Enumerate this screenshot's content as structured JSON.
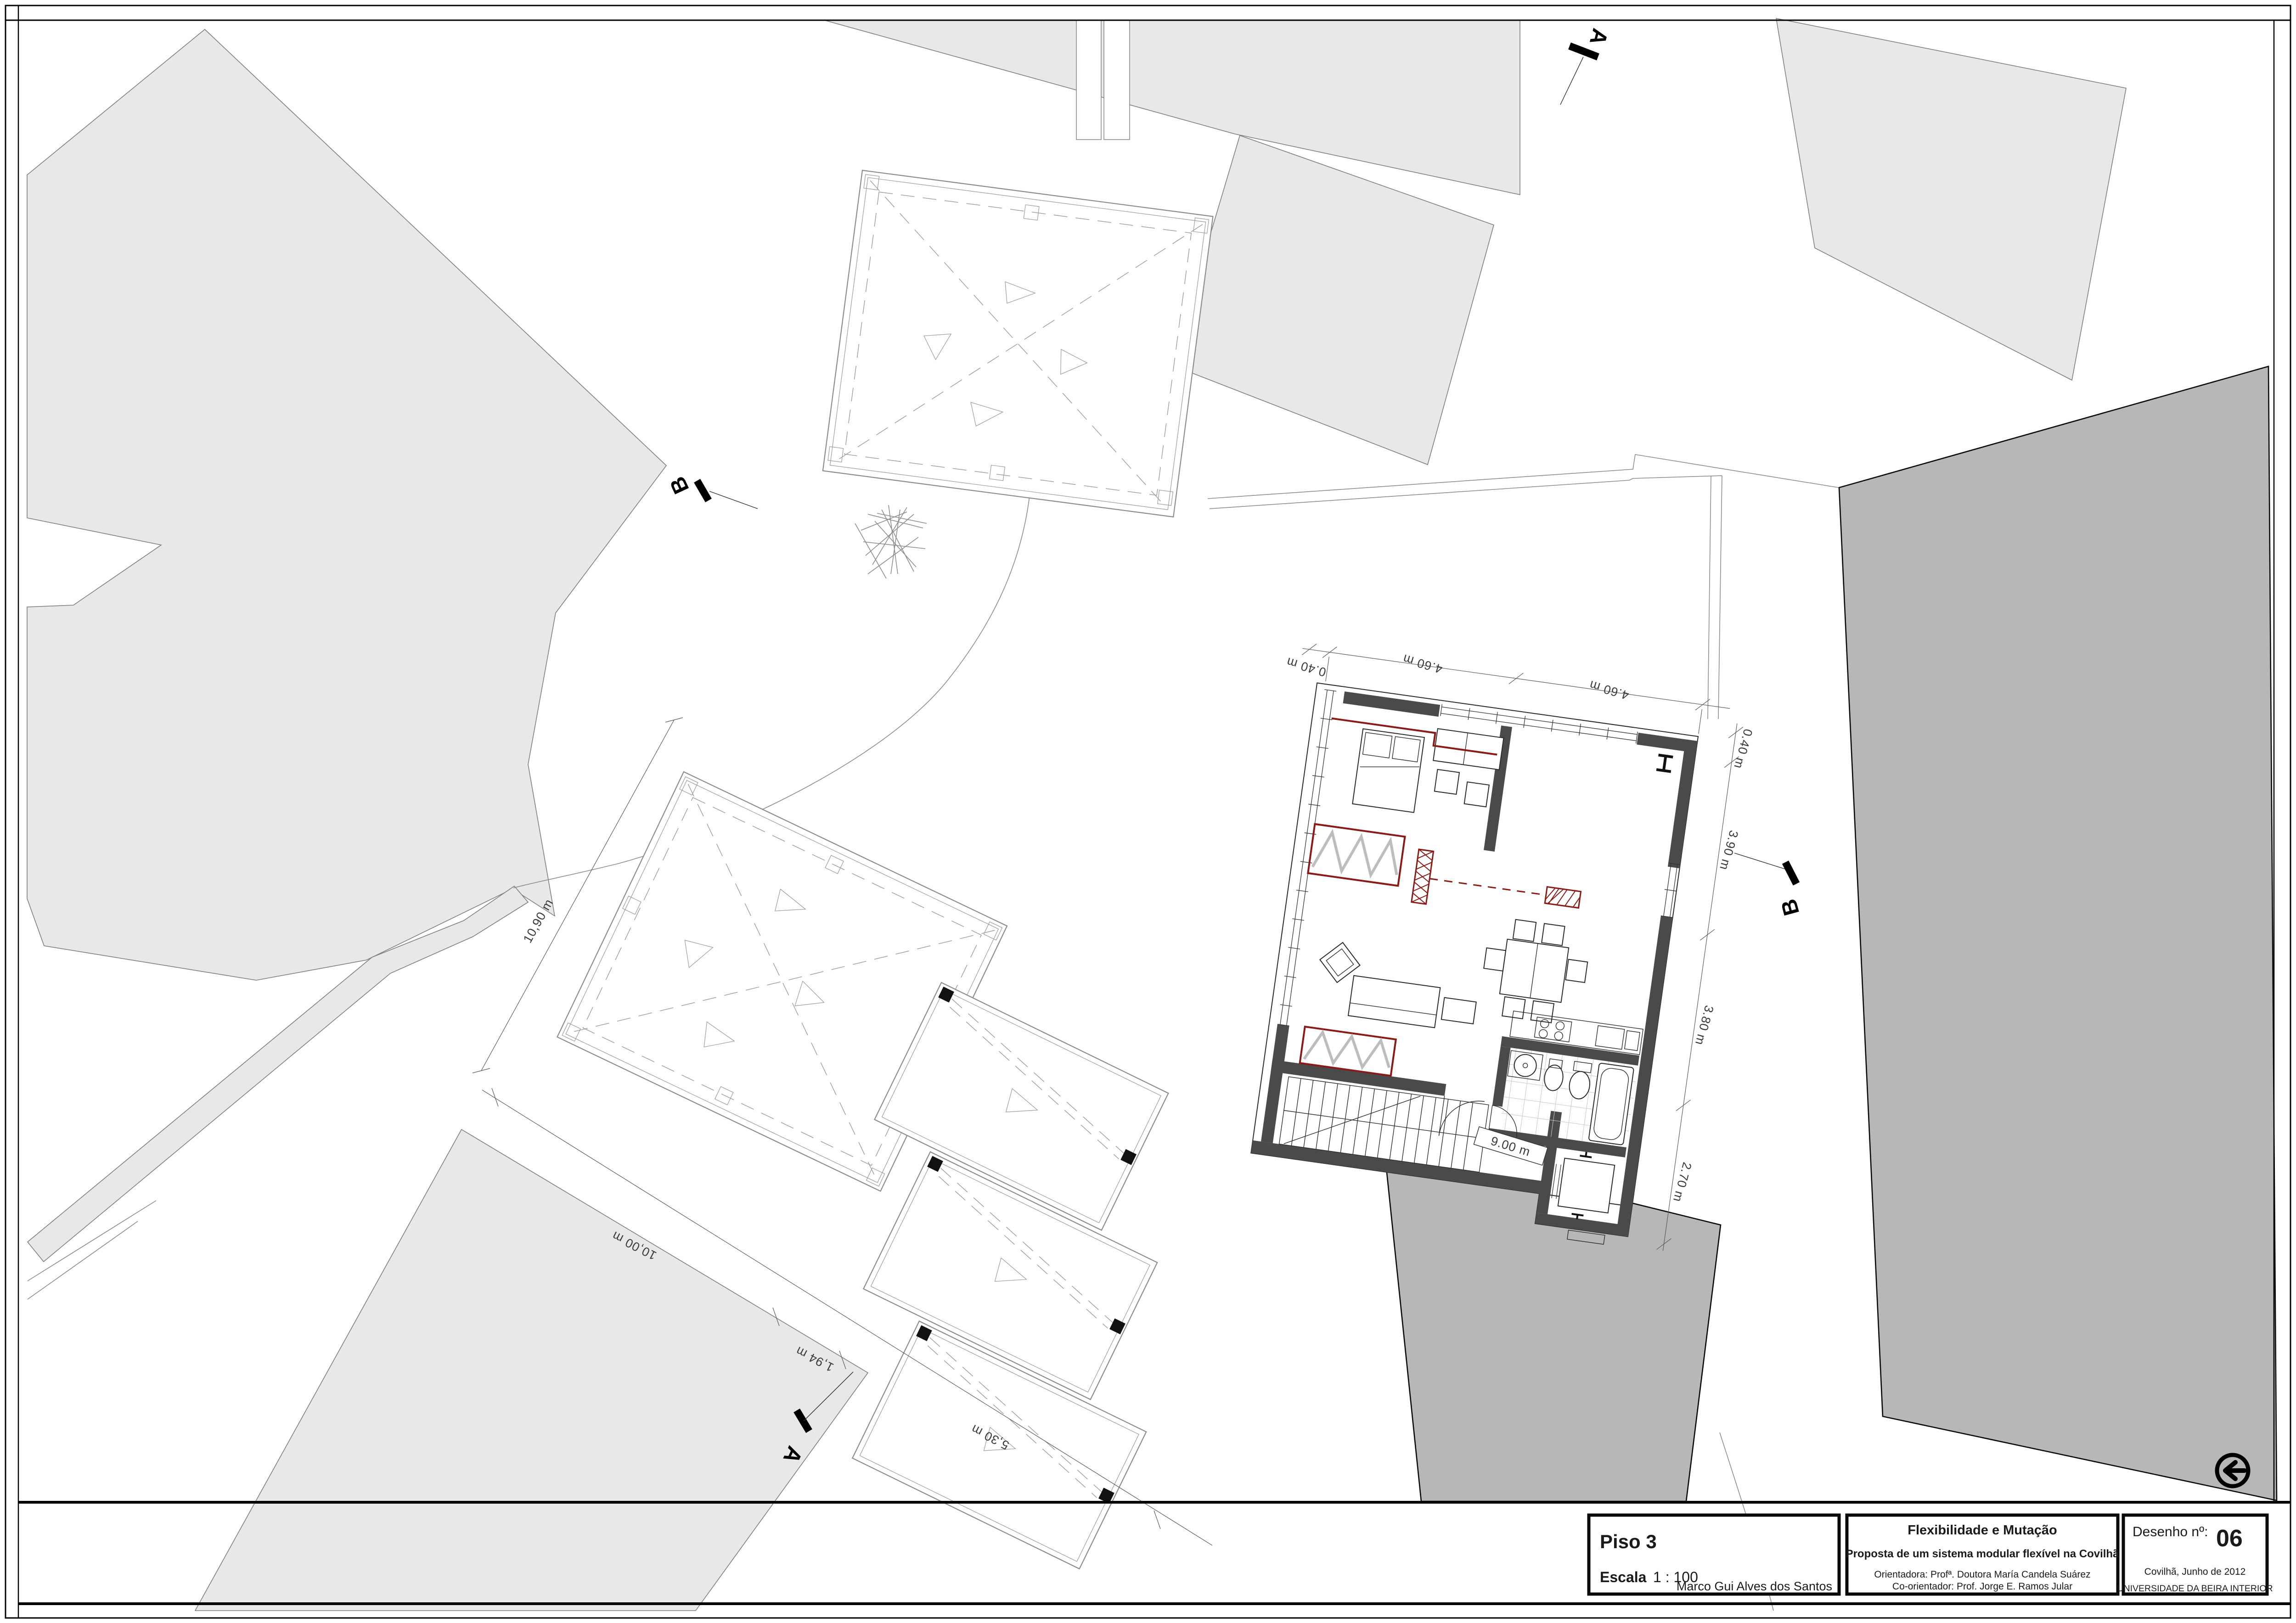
{
  "title_block": {
    "floor": "Piso 3",
    "scale_label": "Escala",
    "scale_value": "1 : 100",
    "author": "Marco Gui Alves dos Santos",
    "project_title": "Flexibilidade e Mutação",
    "project_subtitle": "Proposta de um sistema modular flexível na Covilhã",
    "advisor": "Orientadora: Profª. Doutora María Candela Suárez",
    "co_advisor": "Co-orientador: Prof. Jorge E. Ramos Jular",
    "drawing_no_label": "Desenho nº:",
    "drawing_no": "06",
    "place_date": "Covilhã, Junho de 2012",
    "university": "UNIVERSIDADE DA BEIRA INTERIOR"
  },
  "dimensions": {
    "top_a": "4.60 m",
    "top_b": "4.60 m",
    "corner_top": "0.40 m",
    "right_0": "0.40 m",
    "right_1": "3.90 m",
    "right_2": "3.80 m",
    "right_3": "2.70 m",
    "stair": "9.00 m",
    "roof_nw": "10,90 m",
    "roof_sw": "10,00 m",
    "chain_a": "1,94 m",
    "chain_b": "5,30 m"
  },
  "section_markers": {
    "a": "A",
    "b": "B"
  },
  "icons": {
    "direction": "circle-left-arrow-icon"
  },
  "colors": {
    "accent_red": "#8a1a15",
    "wall": "#4a4a4a",
    "site_fill": "#e8e8e8",
    "building_fill": "#b7b7b7"
  }
}
